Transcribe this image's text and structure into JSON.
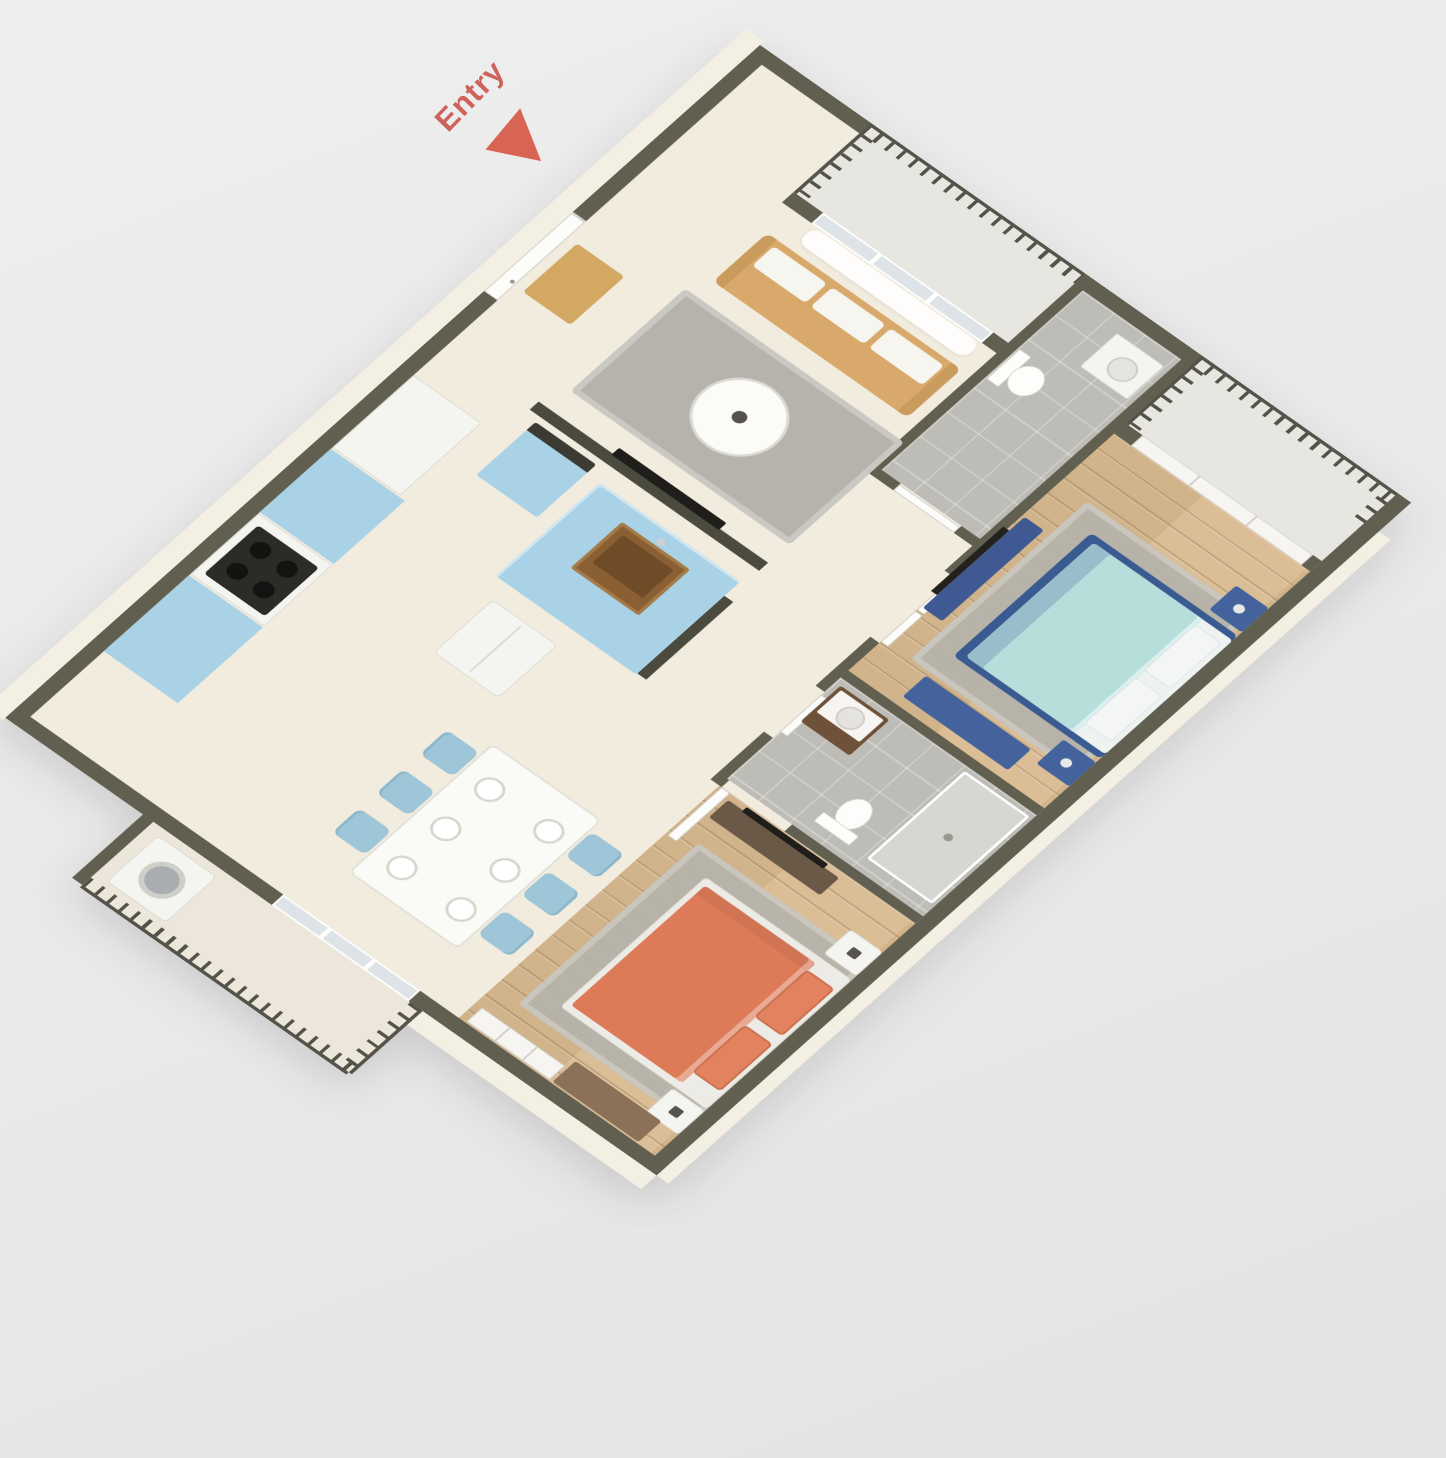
{
  "scene": {
    "description": "3D isometric floor plan rendering of a two-bedroom, two-bathroom apartment",
    "view": "overhead axonometric, plan rotated roughly 41 degrees",
    "background_color": "#e9e9e9"
  },
  "entry_label": {
    "text": "Entry",
    "color": "#c7453a",
    "arrow": "red triangle pointing toward entry door"
  },
  "palette": {
    "wall_top": "#615f4f",
    "wall_accent": "#4b4a3e",
    "wall_face": "#f3efe3",
    "floor_main": "#f2ecdf",
    "floor_wood": "#d9ba90",
    "floor_tile": "#bdbcb6",
    "balcony_floor": "#e7e6e0",
    "kitchen_cabinets": "#a9d2e6",
    "sink_wood": "#8a5f33",
    "dining_chairs": "#9fc6d8",
    "sofa_wood": "#d8a96b",
    "master_duvet_teal": "#b6dfdc",
    "master_frame_navy": "#3a5a92",
    "bedroom2_duvet_coral": "#dd7b59",
    "dresser_brown": "#8a7157",
    "vanity_brown": "#6e5138",
    "rug_gray": "#b5b3ac",
    "railing": "#54534a"
  },
  "rooms": [
    {
      "name": "Living Room",
      "floor": "cream",
      "furniture": [
        "wood-frame sofa with white cushions",
        "round white coffee table",
        "gray area rug",
        "sheer curtains at balcony slider",
        "TV on kitchen partial wall",
        "entry door with tan doormat"
      ]
    },
    {
      "name": "Kitchen",
      "floor": "cream",
      "furniture": [
        "light blue island with wood sink",
        "light blue tall cabinet",
        "light blue counters",
        "white refrigerator",
        "white range with black cooktop",
        "white cabinet"
      ]
    },
    {
      "name": "Dining Area",
      "floor": "cream",
      "furniture": [
        "white rectangular table",
        "6 light blue chairs",
        "6 white place settings"
      ]
    },
    {
      "name": "Hall Bathroom",
      "floor": "gray tile",
      "furniture": [
        "toilet",
        "white vanity with sink"
      ]
    },
    {
      "name": "Hallway",
      "floor": "cream",
      "furniture": [
        "white interior doors"
      ]
    },
    {
      "name": "Master Bedroom",
      "floor": "wood",
      "furniture": [
        "double bed with teal duvet and navy frame",
        "two navy nightstands",
        "navy bench",
        "navy dresser",
        "wall TV",
        "white sliding balcony doors",
        "gray area rug"
      ]
    },
    {
      "name": "Master Bathroom",
      "floor": "gray tile",
      "furniture": [
        "dark wood vanity with white sink top",
        "toilet",
        "shower"
      ]
    },
    {
      "name": "Bedroom 2",
      "floor": "wood",
      "furniture": [
        "double bed with coral duvet and coral pillows",
        "two white nightstands",
        "dark brown media console with TV",
        "brown dresser",
        "white sliding closet doors",
        "gray area rug"
      ]
    }
  ],
  "balconies": [
    {
      "name": "Living Room Balcony",
      "features": [
        "picket railing",
        "sliding glass door with curtains"
      ]
    },
    {
      "name": "Master Bedroom Balcony",
      "features": [
        "picket railing",
        "white sliding doors"
      ]
    },
    {
      "name": "Lower Balcony",
      "features": [
        "picket railing",
        "white washer"
      ]
    }
  ]
}
